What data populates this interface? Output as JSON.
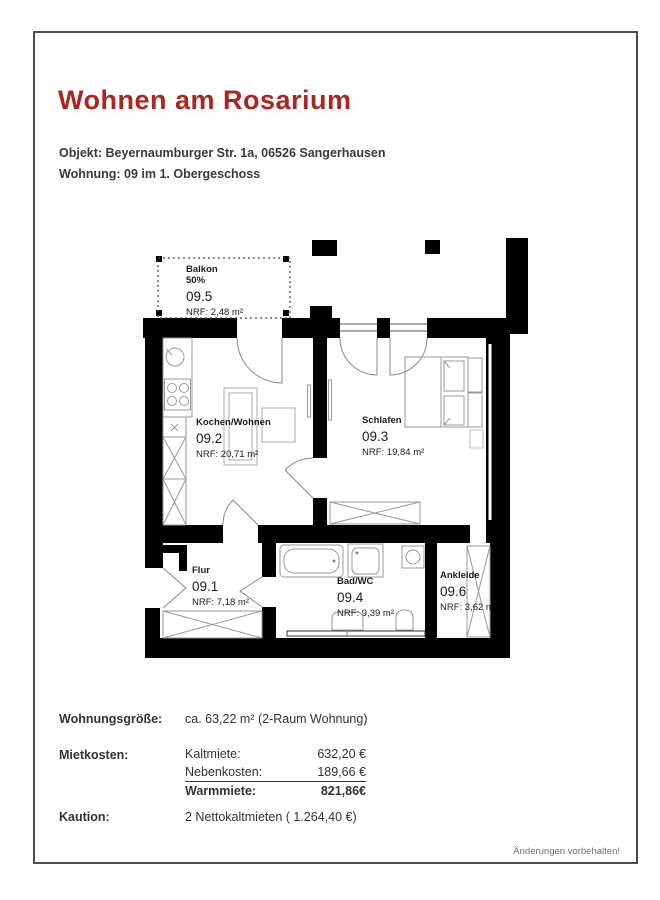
{
  "page": {
    "title": "Wohnen am Rosarium",
    "object_line": "Objekt: Beyernaumburger Str. 1a, 06526 Sangerhausen",
    "unit_line": "Wohnung: 09 im 1. Obergeschoss",
    "footer_note": "Änderungen vorbehalten!"
  },
  "colors": {
    "accent_red": "#b0241f",
    "wall_black": "#000000",
    "border_gray": "#4d4d4d"
  },
  "floorplan": {
    "rooms": [
      {
        "id": "balkon",
        "name": "Balkon",
        "sub": "50%",
        "number": "09.5",
        "area": "NRF: 2,48 m²"
      },
      {
        "id": "kochen-wohnen",
        "name": "Kochen/Wohnen",
        "number": "09.2",
        "area": "NRF: 20,71 m²"
      },
      {
        "id": "schlafen",
        "name": "Schlafen",
        "number": "09.3",
        "area": "NRF: 19,84 m²"
      },
      {
        "id": "flur",
        "name": "Flur",
        "number": "09.1",
        "area": "NRF: 7,18 m²"
      },
      {
        "id": "bad-wc",
        "name": "Bad/WC",
        "number": "09.4",
        "area": "NRF: 9,39 m²"
      },
      {
        "id": "ankleide",
        "name": "Ankleide",
        "number": "09.6",
        "area": "NRF: 3,62 m²"
      }
    ]
  },
  "summary": {
    "size_label": "Wohnungsgröße:",
    "size_value": "ca. 63,22 m² (2-Raum Wohnung)",
    "rent_label": "Mietkosten:",
    "rent_rows": [
      {
        "label": "Kaltmiete:",
        "value": "632,20 €"
      },
      {
        "label": "Nebenkosten:",
        "value": "189,66 €"
      },
      {
        "label": "Warmmiete:",
        "value": "821,86€"
      }
    ],
    "deposit_label": "Kaution:",
    "deposit_value": "2  Nettokaltmieten ( 1.264,40 €)"
  }
}
